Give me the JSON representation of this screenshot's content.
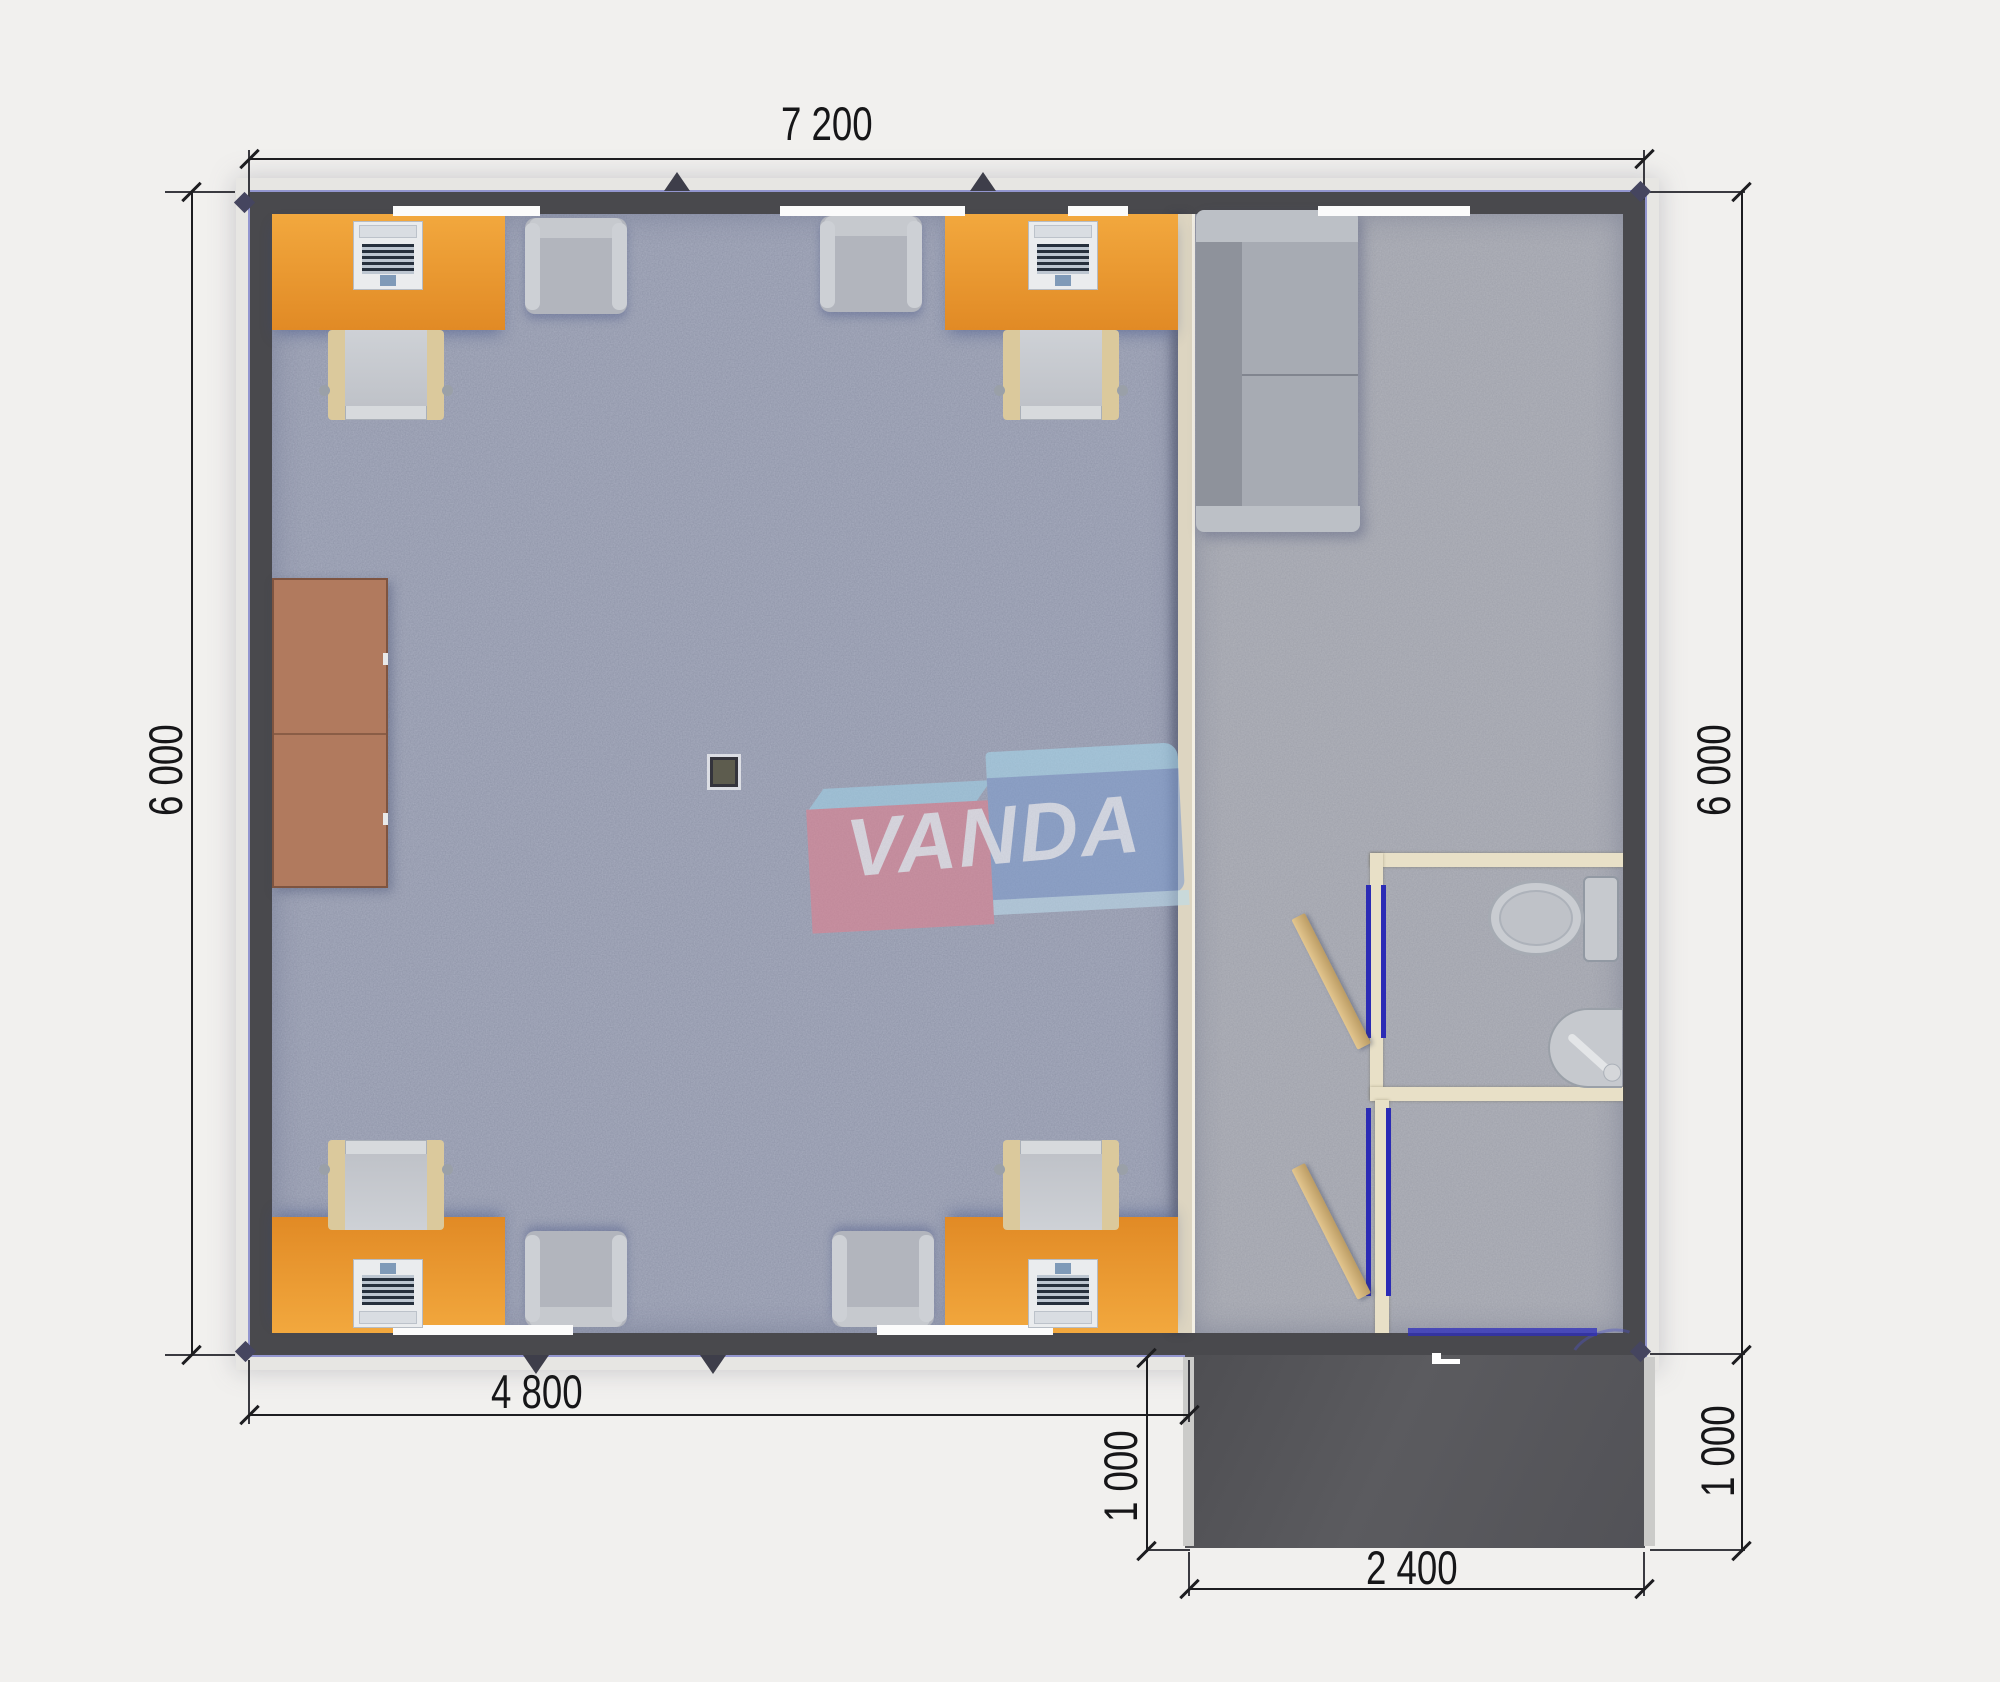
{
  "watermark": {
    "brand": "VANDA"
  },
  "dimensions": {
    "top_width": "7 200",
    "left_height": "6 000",
    "right_height": "6 000",
    "interior_width": "4 800",
    "porch_depth": "1 000",
    "porch_width": "2 400",
    "porch_depth_right": "1 000"
  },
  "colors": {
    "background": "#f1f0ee",
    "wall_dark": "#49494d",
    "wall_blue_outline": "#4e54c0",
    "floor_office": "#a8adbf",
    "floor_lounge": "#b1b3bb",
    "desk_orange": "#e8952e",
    "cabinet_brown": "#b17a5e",
    "sofa_gray": "#a7abb3",
    "bathroom_wall_cream": "#e8e0c7",
    "door_wood_tan": "#d4b67f",
    "door_frame_blue": "#2b2bb5",
    "porch_dark": "#56565a",
    "dimension_text": "#1d1d20",
    "watermark_pink": "#e27f8e",
    "watermark_blue": "#7e9cce",
    "watermark_light_blue": "#a6d7ec"
  }
}
